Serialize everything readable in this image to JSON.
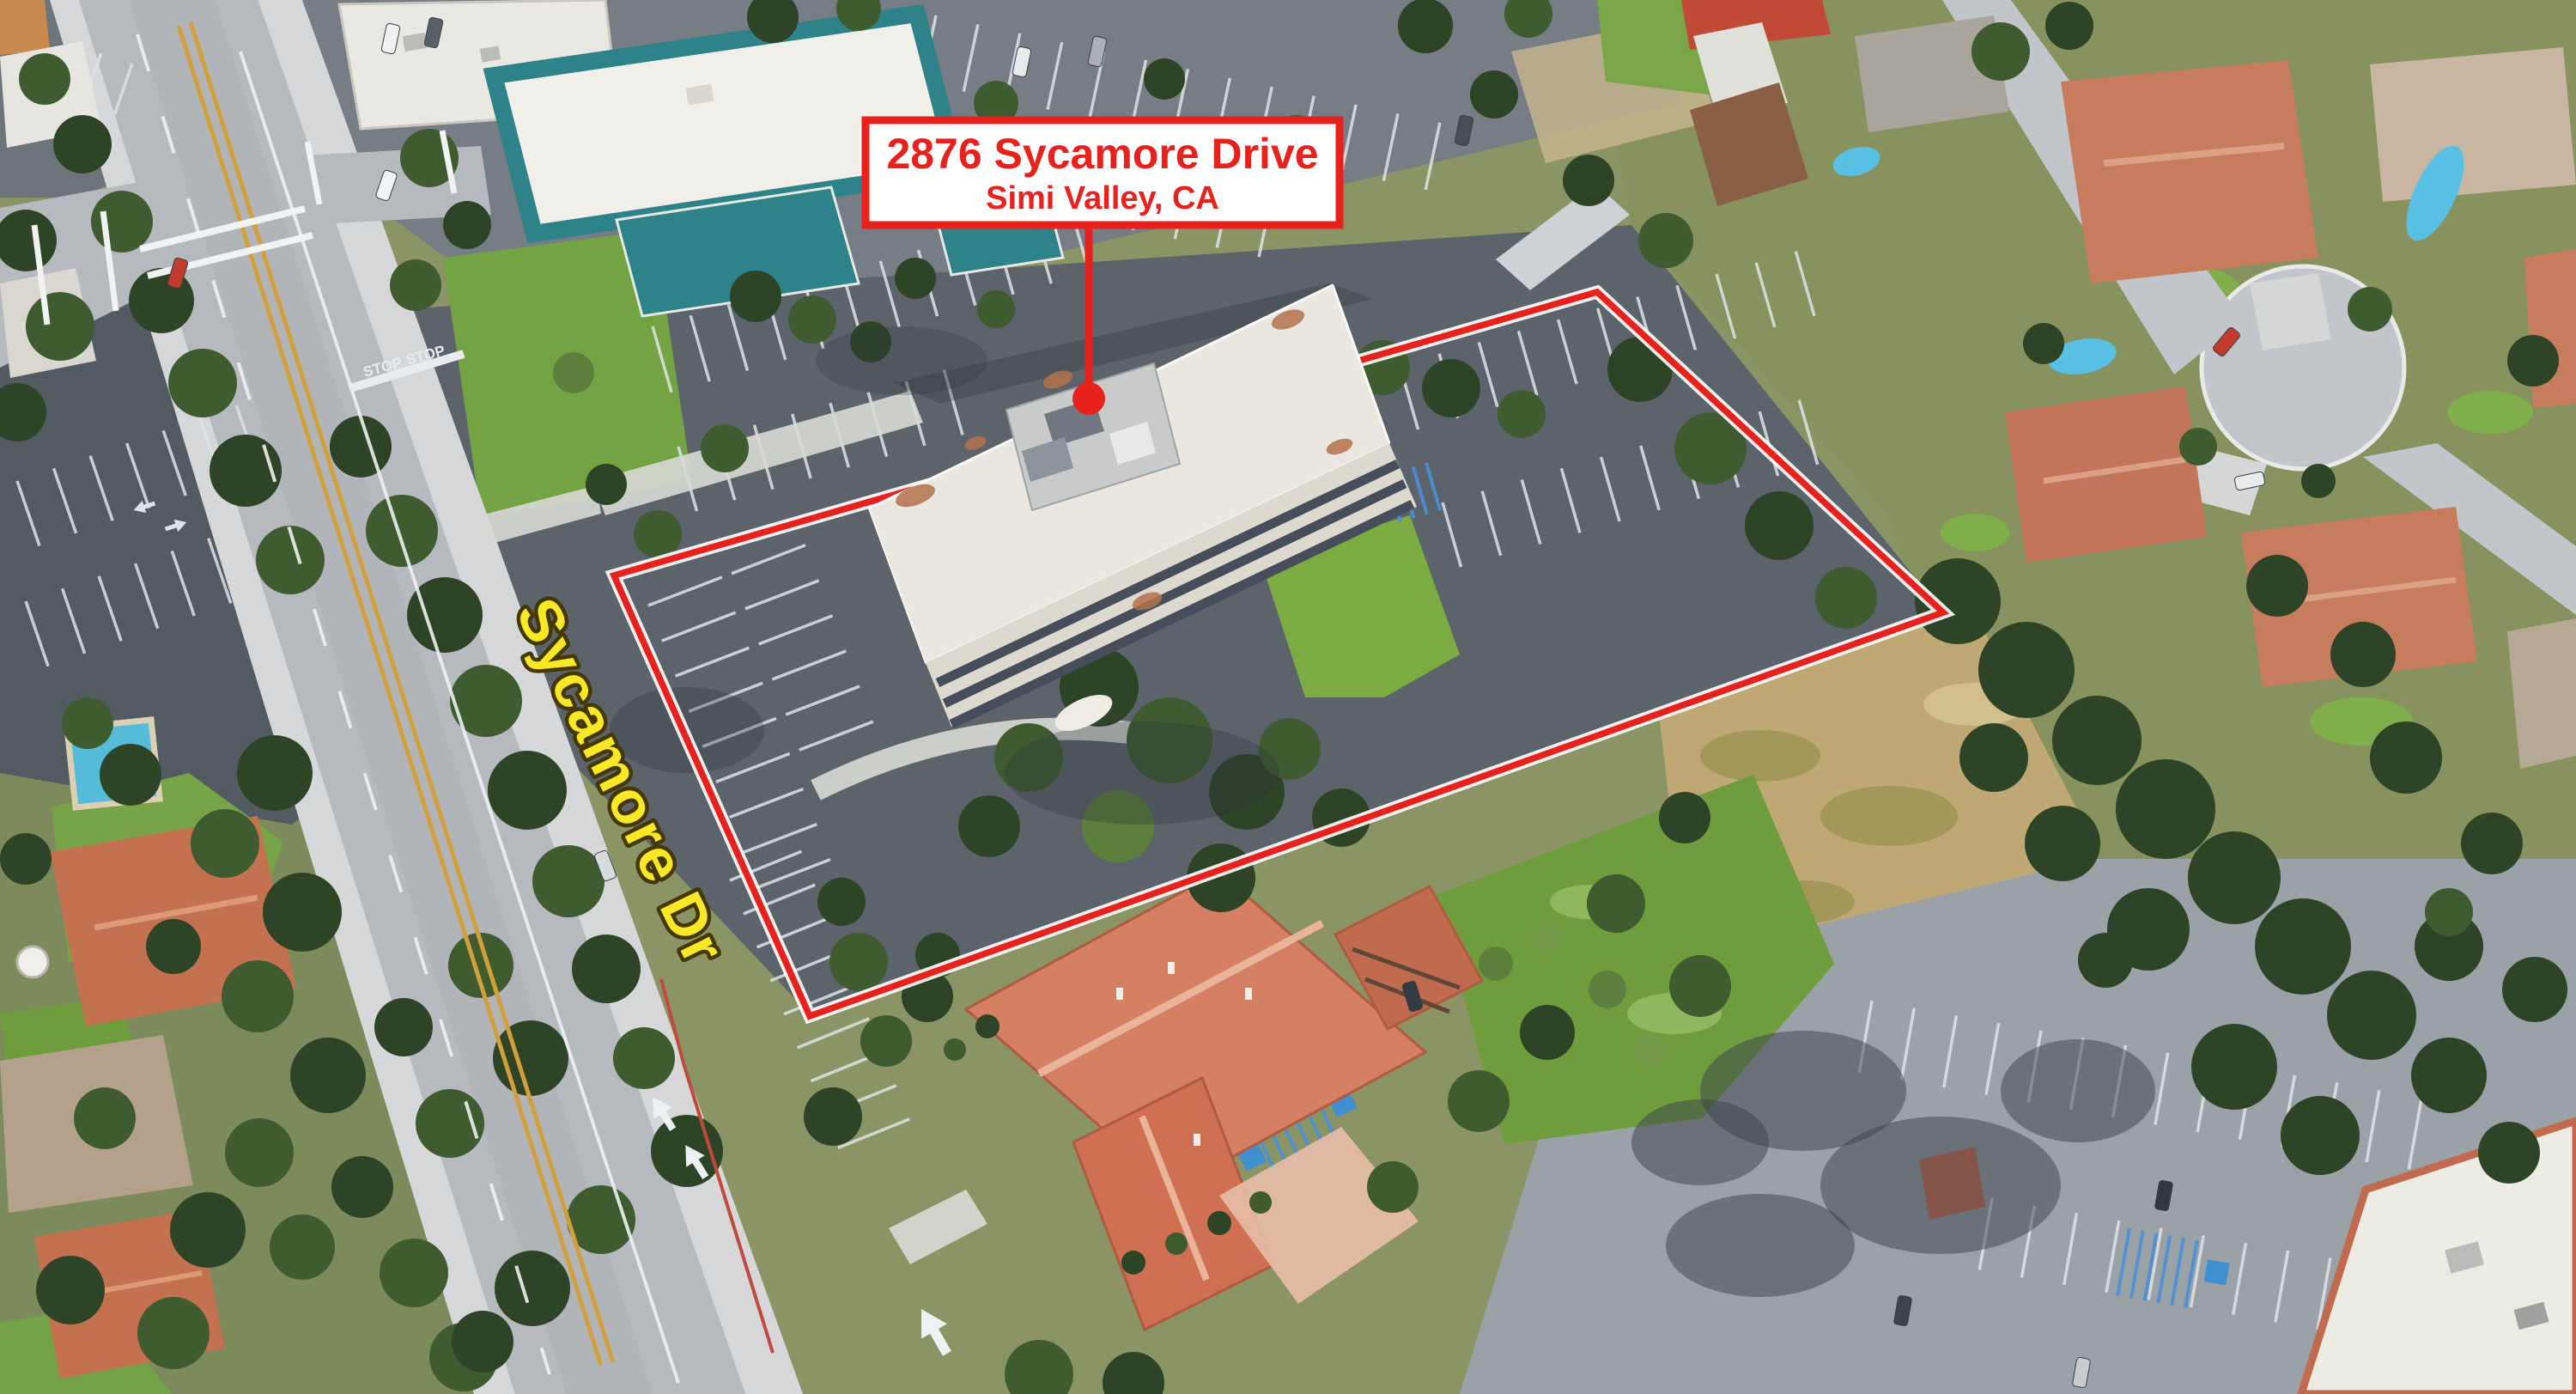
{
  "scene": {
    "type": "oblique-aerial-photo",
    "street_label": "Sycamore Dr",
    "road_stop_marking": "STOP"
  },
  "callout": {
    "line1": "2876 Sycamore Drive",
    "line2": "Simi Valley, CA"
  },
  "colors": {
    "annotation_red": "#e8211d",
    "halo_white": "#ffffff",
    "street_label_yellow": "#f8e825",
    "street_label_outline": "#443800",
    "callout_background": "#ffffff"
  }
}
